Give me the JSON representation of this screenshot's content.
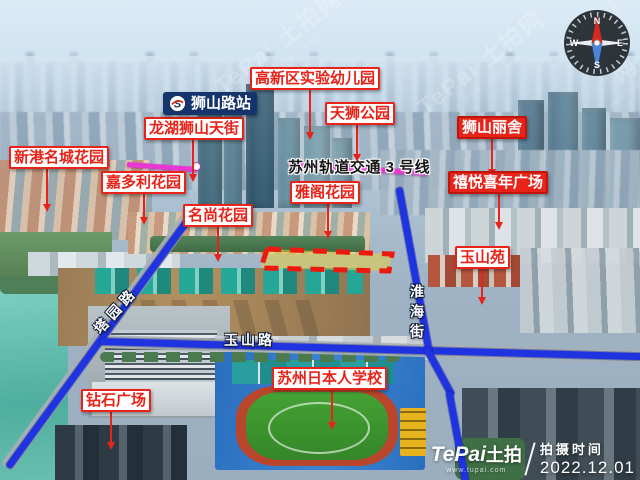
{
  "metro": {
    "line_label": "苏州轨道交通 3 号线",
    "station_label": "狮山路站"
  },
  "roads": {
    "tayuan": "塔园路",
    "yushan": "玉山路",
    "huaihai": "淮海街"
  },
  "pois": {
    "xingang": "新港名城花园",
    "jiaduoli": "嘉多利花园",
    "mingshang": "名尚花园",
    "longhu": "龙湖狮山天街",
    "gaoxin_kindergarten": "高新区实验幼儿园",
    "tianshi_park": "天狮公园",
    "shishan_lishe": "狮山丽舍",
    "xiyue_plaza": "禧悦喜年广场",
    "yage": "雅阁花园",
    "yushan_yuan": "玉山苑",
    "zuanshi_plaza": "钻石广场",
    "japanese_school": "苏州日本人学校"
  },
  "compass": {
    "north": "N",
    "east": "E",
    "south": "S",
    "west": "W"
  },
  "watermark": {
    "brand": "TePai 土拍网",
    "url": "www.tupai.com"
  },
  "footer": {
    "logo_latin": "TePai",
    "logo_cn": "土拍",
    "url": "www.tupai.com",
    "shoot_label": "拍摄时间",
    "shoot_date": "2022.12.01"
  },
  "colors": {
    "label_red": "#e8231a",
    "station_navy": "#14346b",
    "road_blue": "#1f33e0",
    "metro_magenta": "#e837d2",
    "parcel_stroke": "#ec1a0e",
    "parcel_fill": "#e7cd40"
  }
}
